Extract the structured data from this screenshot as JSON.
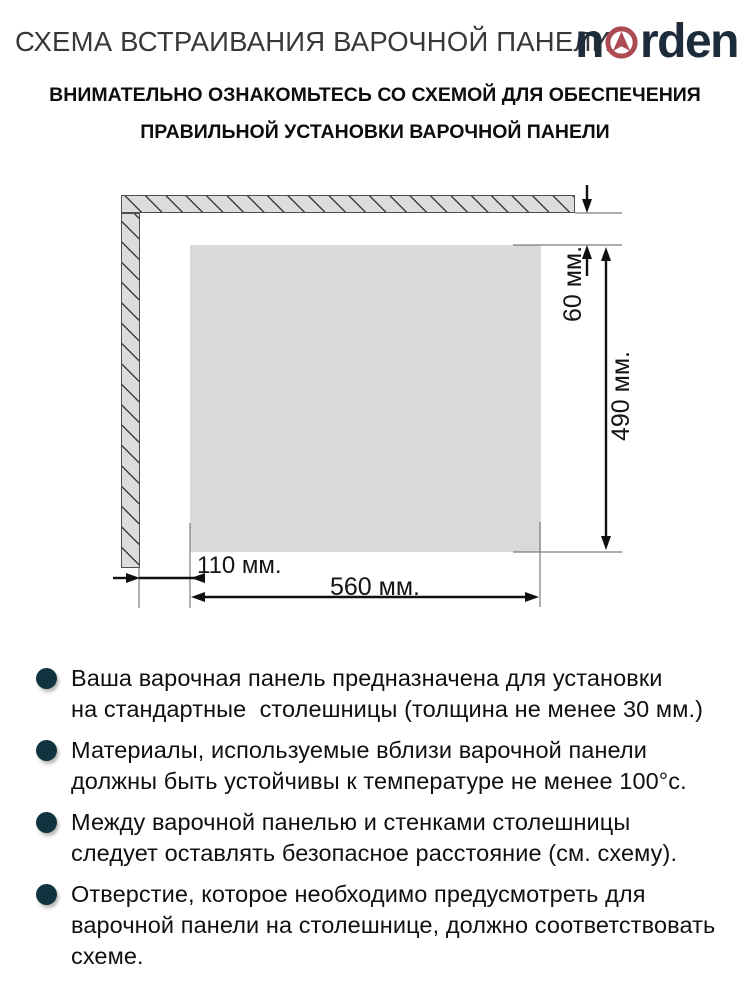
{
  "header": {
    "title": "СХЕМА ВСТРАИВАНИЯ ВАРОЧНОЙ ПАНЕЛИ",
    "logo": {
      "prefix": "n",
      "icon": "compass-arrow-icon",
      "suffix": "rden"
    },
    "subtitle_line1": "ВНИМАТЕЛЬНО ОЗНАКОМЬТЕСЬ СО СХЕМОЙ ДЛЯ ОБЕСПЕЧЕНИЯ",
    "subtitle_line2": "ПРАВИЛЬНОЙ УСТАНОВКИ ВАРОЧНОЙ ПАНЕЛИ"
  },
  "diagram": {
    "dim_top_gap": "60 мм.",
    "dim_height": "490 мм.",
    "dim_left_gap": "110 мм.",
    "dim_width": "560 мм."
  },
  "notes": [
    {
      "text": "Ваша варочная панель предназначена для установки\nна стандартные  столешницы (толщина не менее 30 мм.)"
    },
    {
      "text": "Материалы, используемые вблизи варочной панели\nдолжны быть устойчивы к температуре не менее 100°с."
    },
    {
      "text": "Между варочной панелью и стенками столешницы\nследует оставлять безопасное расстояние (см. схему)."
    },
    {
      "text": "Отверстие, которое необходимо предусмотреть для\nварочной панели на столешнице, должно соответствовать\nсхеме."
    }
  ],
  "colors": {
    "title": "#383838",
    "logo_navy": "#1d2c3a",
    "logo_red": "#ad4b53",
    "bullet": "#11333f",
    "wall_fill": "#dcdcdc",
    "cutout_fill": "#d9d9d9"
  }
}
